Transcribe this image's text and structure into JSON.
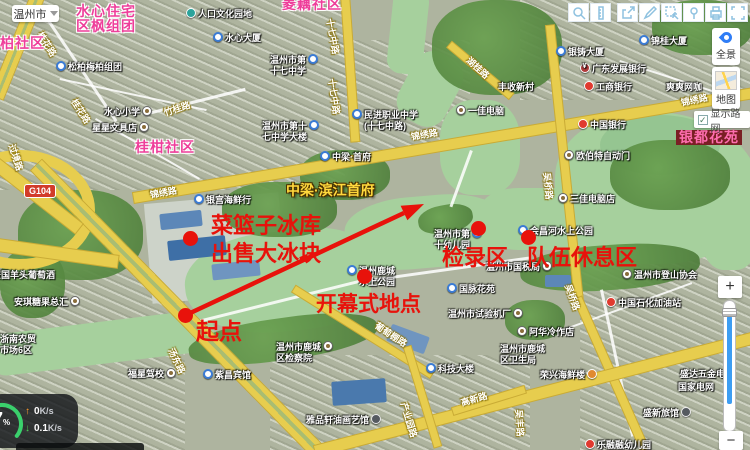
{
  "chrome": {
    "city": "温州市",
    "toolbar_icons": [
      "zoom-search",
      "ruler",
      "share",
      "pencil",
      "select-area",
      "marker",
      "printer",
      "fullscreen"
    ],
    "panorama": "全景",
    "map_mode": "地图",
    "roadnet": "显示路网",
    "checkmark": "✓",
    "zoom_in": "+",
    "zoom_out": "−"
  },
  "monitor": {
    "percent_value": "7",
    "percent_unit": "%",
    "up": {
      "arrow": "↑",
      "value": "0",
      "unit": "K/s"
    },
    "down": {
      "arrow": "↓",
      "value": "0.1",
      "unit": "K/s"
    }
  },
  "annotations": {
    "color": "#e8120b",
    "ice_line1": "菜篮子冰库",
    "ice_line2": "出售大冰块",
    "start": "起点",
    "opening": "开幕式地点",
    "checkin": "检录区",
    "rest": "队伍休息区"
  },
  "map": {
    "ad_label": {
      "text": "中梁·滨江首府",
      "x": 286,
      "y": 180
    },
    "shield": {
      "text": "G104",
      "x": 24,
      "y": 184
    },
    "area_labels": [
      {
        "lines": [
          "水心住宅",
          "区枫组团"
        ],
        "x": 76,
        "y": 4
      },
      {
        "lines": [
          "松柏社区"
        ],
        "x": -15,
        "y": 36
      },
      {
        "lines": [
          "桂柑社区"
        ],
        "x": 135,
        "y": 140
      },
      {
        "lines": [
          "菱藕社区"
        ],
        "x": 282,
        "y": -3
      },
      {
        "lines": [
          "银都花苑"
        ],
        "x": 676,
        "y": 130,
        "boxed": true
      }
    ],
    "road_labels": [
      {
        "text": "桂花路",
        "x": 40,
        "y": 26,
        "rot": 58
      },
      {
        "text": "桂花路",
        "x": 74,
        "y": 93,
        "rot": 58
      },
      {
        "text": "竹桂路",
        "x": 164,
        "y": 106,
        "rot": -18
      },
      {
        "text": "十七中路",
        "x": 330,
        "y": 12,
        "rot": 80
      },
      {
        "text": "十七中路",
        "x": 332,
        "y": 72,
        "rot": 82
      },
      {
        "text": "锦绣路",
        "x": 150,
        "y": 188,
        "rot": -10
      },
      {
        "text": "锦绣路",
        "x": 411,
        "y": 130,
        "rot": -10
      },
      {
        "text": "锦绣路",
        "x": 681,
        "y": 96,
        "rot": -12
      },
      {
        "text": "湖桂路",
        "x": 468,
        "y": 52,
        "rot": 42
      },
      {
        "text": "过境路",
        "x": 12,
        "y": 138,
        "rot": 72
      },
      {
        "text": "吴桥路",
        "x": 547,
        "y": 166,
        "rot": 84
      },
      {
        "text": "吴桥路",
        "x": 568,
        "y": 278,
        "rot": 70
      },
      {
        "text": "汤东路",
        "x": 171,
        "y": 342,
        "rot": 64
      },
      {
        "text": "吴丰路",
        "x": 519,
        "y": 403,
        "rot": 86
      },
      {
        "text": "葡萄棚路",
        "x": 376,
        "y": 318,
        "rot": 33
      },
      {
        "text": "产业园路",
        "x": 404,
        "y": 396,
        "rot": 73
      },
      {
        "text": "高新路",
        "x": 461,
        "y": 396,
        "rot": -16
      }
    ],
    "pois": [
      {
        "l": [
          "人口文化园地"
        ],
        "x": 186,
        "y": 9,
        "i": "teal",
        "p": "b"
      },
      {
        "l": [
          "水心大厦"
        ],
        "x": 213,
        "y": 33,
        "i": "L",
        "p": "b"
      },
      {
        "l": [
          "松柏梅柏组团"
        ],
        "x": 56,
        "y": 62,
        "i": "L",
        "p": "b"
      },
      {
        "l": [
          "水心小学"
        ],
        "x": 104,
        "y": 107,
        "i": "o",
        "p": "a"
      },
      {
        "l": [
          "星星文具店"
        ],
        "x": 92,
        "y": 123,
        "i": "o",
        "p": "a"
      },
      {
        "l": [
          "温州市第",
          "十七中学"
        ],
        "x": 270,
        "y": 55,
        "i": "L",
        "p": "a"
      },
      {
        "l": [
          "温州市第十",
          "七中学大楼"
        ],
        "x": 262,
        "y": 121,
        "i": "L",
        "p": "a"
      },
      {
        "l": [
          "民进职业中学",
          "(十七中路)"
        ],
        "x": 352,
        "y": 110,
        "i": "L",
        "p": "b"
      },
      {
        "l": [
          "一佳电脑"
        ],
        "x": 456,
        "y": 106,
        "i": "o",
        "p": "b"
      },
      {
        "l": [
          "丰收新村"
        ],
        "x": 498,
        "y": 82
      },
      {
        "l": [
          "银铸大厦"
        ],
        "x": 556,
        "y": 47,
        "i": "L",
        "p": "b"
      },
      {
        "l": [
          "锦桂大厦"
        ],
        "x": 639,
        "y": 36,
        "i": "L",
        "p": "b"
      },
      {
        "l": [
          "广东发展银行"
        ],
        "x": 580,
        "y": 64,
        "i": "yen",
        "p": "b"
      },
      {
        "l": [
          "工商银行"
        ],
        "x": 584,
        "y": 82,
        "i": "red",
        "p": "b"
      },
      {
        "l": [
          "爽爽网咖"
        ],
        "x": 666,
        "y": 82
      },
      {
        "l": [
          "中国银行"
        ],
        "x": 578,
        "y": 120,
        "i": "red",
        "p": "b"
      },
      {
        "l": [
          "欧伯特自动门"
        ],
        "x": 564,
        "y": 151,
        "i": "o",
        "p": "b"
      },
      {
        "l": [
          "中梁·首府"
        ],
        "x": 320,
        "y": 152,
        "i": "L",
        "p": "b"
      },
      {
        "l": [
          "银宫海鲜行"
        ],
        "x": 194,
        "y": 195,
        "i": "L",
        "p": "b"
      },
      {
        "l": [
          "三佳电脑店"
        ],
        "x": 558,
        "y": 194,
        "i": "o",
        "p": "b"
      },
      {
        "l": [
          "会昌河水上公园"
        ],
        "x": 518,
        "y": 226,
        "i": "L",
        "p": "b"
      },
      {
        "l": [
          "温州市第",
          "十幼儿园"
        ],
        "x": 434,
        "y": 229,
        "i": "L",
        "p": "a"
      },
      {
        "l": [
          "温州鹿城",
          "水上公园"
        ],
        "x": 347,
        "y": 266,
        "i": "L",
        "p": "b"
      },
      {
        "l": [
          "温州市国税局"
        ],
        "x": 486,
        "y": 262,
        "i": "o",
        "p": "a"
      },
      {
        "l": [
          "国脉花苑"
        ],
        "x": 447,
        "y": 284,
        "i": "L",
        "p": "b"
      },
      {
        "l": [
          "温州市登山协会"
        ],
        "x": 622,
        "y": 270,
        "i": "o",
        "p": "b"
      },
      {
        "l": [
          "中国石化加油站"
        ],
        "x": 606,
        "y": 298,
        "i": "red",
        "p": "b"
      },
      {
        "l": [
          "温州市试验机厂"
        ],
        "x": 448,
        "y": 309,
        "i": "o",
        "p": "a"
      },
      {
        "l": [
          "阿华冷作店"
        ],
        "x": 517,
        "y": 327,
        "i": "o",
        "p": "b"
      },
      {
        "l": [
          "温州市鹿城",
          "区卫生局"
        ],
        "x": 500,
        "y": 344
      },
      {
        "l": [
          "科技大楼"
        ],
        "x": 426,
        "y": 364,
        "i": "L",
        "p": "b"
      },
      {
        "l": [
          "荣兴海鲜楼"
        ],
        "x": 540,
        "y": 370,
        "i": "org",
        "p": "a"
      },
      {
        "l": [
          "盛达五金电"
        ],
        "x": 680,
        "y": 369
      },
      {
        "l": [
          "国家电网"
        ],
        "x": 678,
        "y": 382
      },
      {
        "l": [
          "盛新旅馆"
        ],
        "x": 643,
        "y": 408,
        "i": "dark",
        "p": "a"
      },
      {
        "l": [
          "温州市鹿城",
          "区检察院"
        ],
        "x": 276,
        "y": 342,
        "i": "o",
        "p": "a"
      },
      {
        "l": [
          "雅品轩油画艺馆"
        ],
        "x": 306,
        "y": 415,
        "i": "dark",
        "p": "a"
      },
      {
        "l": [
          "紫昌宾馆"
        ],
        "x": 203,
        "y": 370,
        "i": "L",
        "p": "b"
      },
      {
        "l": [
          "福星驾校"
        ],
        "x": 128,
        "y": 369,
        "i": "o",
        "p": "a"
      },
      {
        "l": [
          "安琪糖果总汇"
        ],
        "x": 14,
        "y": 297,
        "i": "o",
        "p": "a"
      },
      {
        "l": [
          "法国羊头葡萄酒"
        ],
        "x": -8,
        "y": 270
      },
      {
        "l": [
          "浙南农贸",
          "市场6区"
        ],
        "x": 0,
        "y": 334
      },
      {
        "l": [
          "乐融融幼儿园"
        ],
        "x": 585,
        "y": 440,
        "i": "red",
        "p": "b"
      }
    ]
  }
}
